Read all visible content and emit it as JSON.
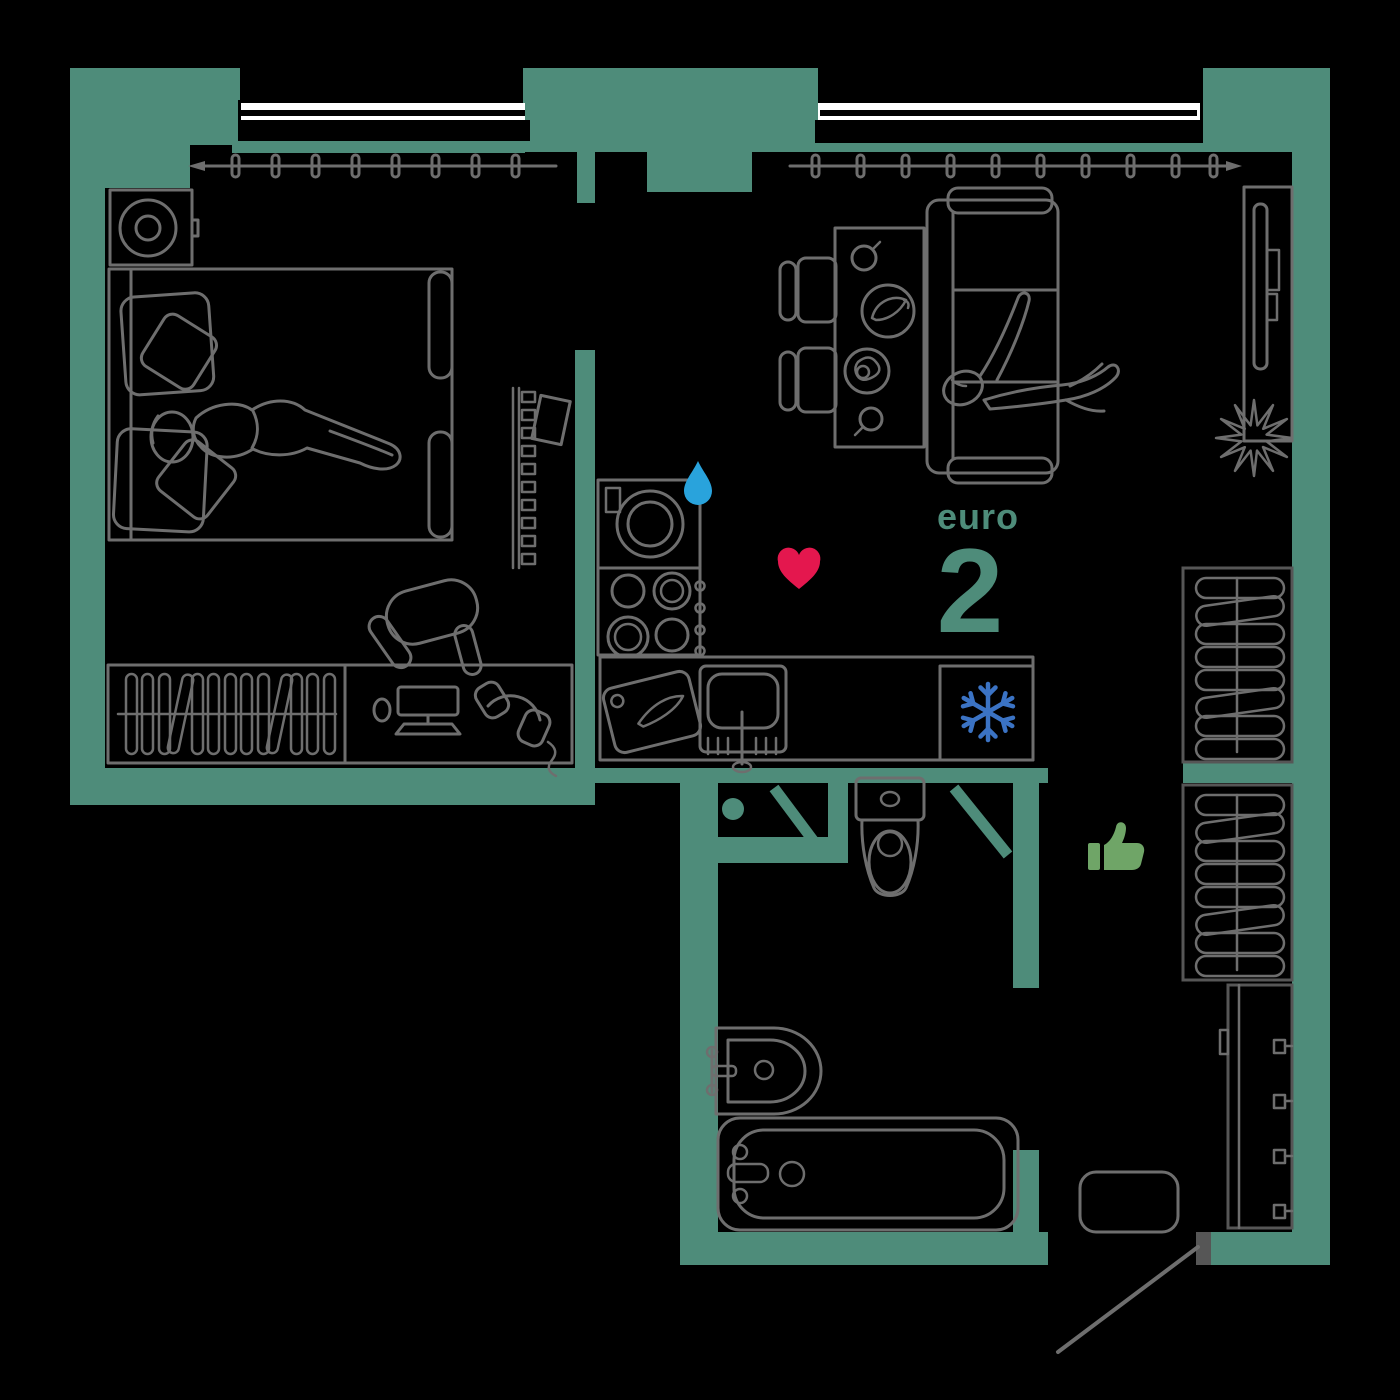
{
  "plan": {
    "label": {
      "prefix": "euro",
      "number": "2"
    },
    "colors": {
      "background": "#000000",
      "wall": "#4E8C7A",
      "furniture_line": "#6E6E6E",
      "window_backdrop": "#FFFFFF",
      "window_frame": "#000000",
      "door_threshold": "#565656",
      "heart": "#E4174E",
      "water_drop": "#29A3DC",
      "snowflake": "#3B73C4",
      "thumbs_up": "#6FA567",
      "label_text": "#4E8C7A"
    },
    "icons": [
      {
        "name": "water-drop-icon",
        "meaning": "water / washing machine point",
        "color": "#29A3DC"
      },
      {
        "name": "heart-icon",
        "meaning": "favourite mark",
        "color": "#E4174E"
      },
      {
        "name": "snowflake-icon",
        "meaning": "refrigerator",
        "color": "#3B73C4"
      },
      {
        "name": "thumbs-up-icon",
        "meaning": "approved mark",
        "color": "#6FA567"
      }
    ],
    "rooms": [
      {
        "name": "bedroom",
        "furniture": [
          "double bed with pillows",
          "sleeping person",
          "bedside table with lamp",
          "window with curtain",
          "ladder shelf",
          "wardrobe with hangers",
          "desk with monitor, keyboard, mouse, headphones",
          "office chair"
        ]
      },
      {
        "name": "living-room",
        "furniture": [
          "sofa with lounging person",
          "dining table with cups and plates",
          "two chairs",
          "tv console with wall tv",
          "potted plant",
          "window with curtain",
          "wardrobe with hangers"
        ]
      },
      {
        "name": "kitchen",
        "furniture": [
          "washing machine",
          "cooktop with four burners",
          "countertop",
          "cutting board with knife",
          "sink with tap",
          "refrigerator"
        ]
      },
      {
        "name": "bathroom",
        "furniture": [
          "toilet",
          "wash basin",
          "bathtub",
          "two door leaves"
        ]
      },
      {
        "name": "hallway",
        "furniture": [
          "wardrobe with hangers",
          "shoe cabinet with hooks",
          "rug",
          "entrance door swing"
        ]
      }
    ]
  }
}
